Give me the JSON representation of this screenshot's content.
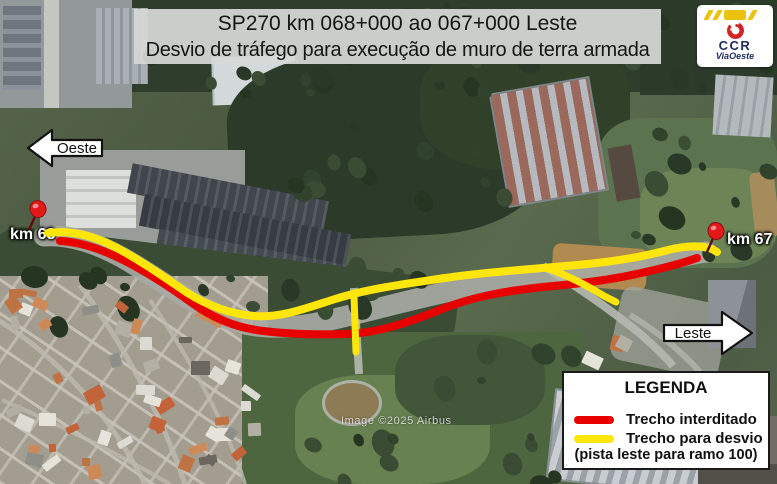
{
  "colors": {
    "closed_route": "#e60000",
    "detour_route": "#ffe60a",
    "logo_red": "#d12428",
    "logo_navy": "#1d2d5e",
    "logo_yellow": "#edc20e"
  },
  "header": {
    "title_line1": "SP270 km 068+000 ao 067+000 Leste",
    "title_line2": "Desvio de tráfego para execução de muro de terra armada"
  },
  "logo": {
    "company": "CCR",
    "division": "ViaOeste"
  },
  "direction_labels": {
    "west": "Oeste",
    "east": "Leste"
  },
  "km_markers": [
    {
      "id": "km-68",
      "label": "km 68"
    },
    {
      "id": "km-67",
      "label": "km 67"
    }
  ],
  "legend": {
    "title": "LEGENDA",
    "items": [
      {
        "label": "Trecho interditado",
        "color": "#e60000"
      },
      {
        "label": "Trecho para desvio",
        "color": "#ffe60a"
      }
    ],
    "note": "(pista leste para ramo 100)"
  },
  "map": {
    "attribution": "Image ©2025 Airbus"
  }
}
